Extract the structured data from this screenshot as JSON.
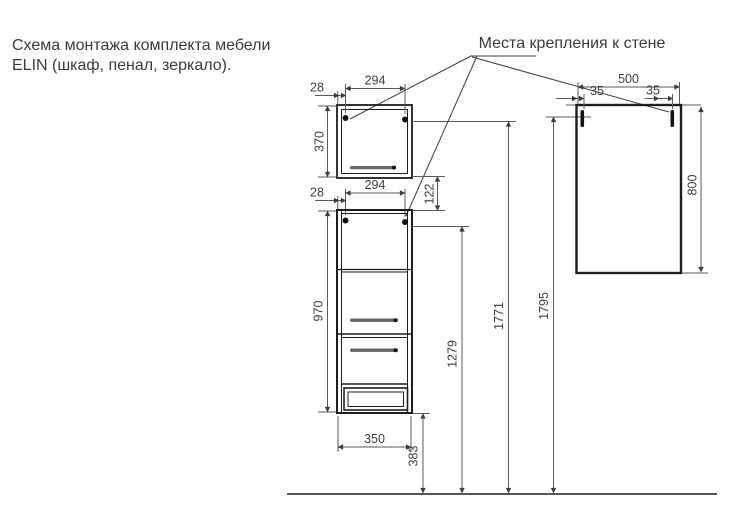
{
  "title": {
    "line1": "Схема монтажа комплекта мебели",
    "line2": "ELIN (шкаф, пенал, зеркало)."
  },
  "callout": {
    "label": "Места крепления к стене"
  },
  "colors": {
    "outline": "#1d1d1d",
    "dimension_lines": "#5a5a5a",
    "text": "#3d3d3d",
    "background": "#ffffff"
  },
  "dimensions": {
    "wall_cabinet": {
      "mount_spacing": "294",
      "mount_edge_offset": "28",
      "height": "370"
    },
    "between_units": {
      "mount_spacing": "294",
      "mount_edge_offset": "28",
      "vertical_gap": "122"
    },
    "tall_cabinet": {
      "height": "970",
      "width": "350",
      "bottom_to_floor": "383"
    },
    "mount_heights": {
      "tall_cabinet": "1279",
      "wall_cabinet": "1771",
      "mirror": "1795"
    },
    "mirror": {
      "width": "500",
      "mount_left_offset": "35",
      "mount_right_offset": "35",
      "height": "800"
    }
  }
}
